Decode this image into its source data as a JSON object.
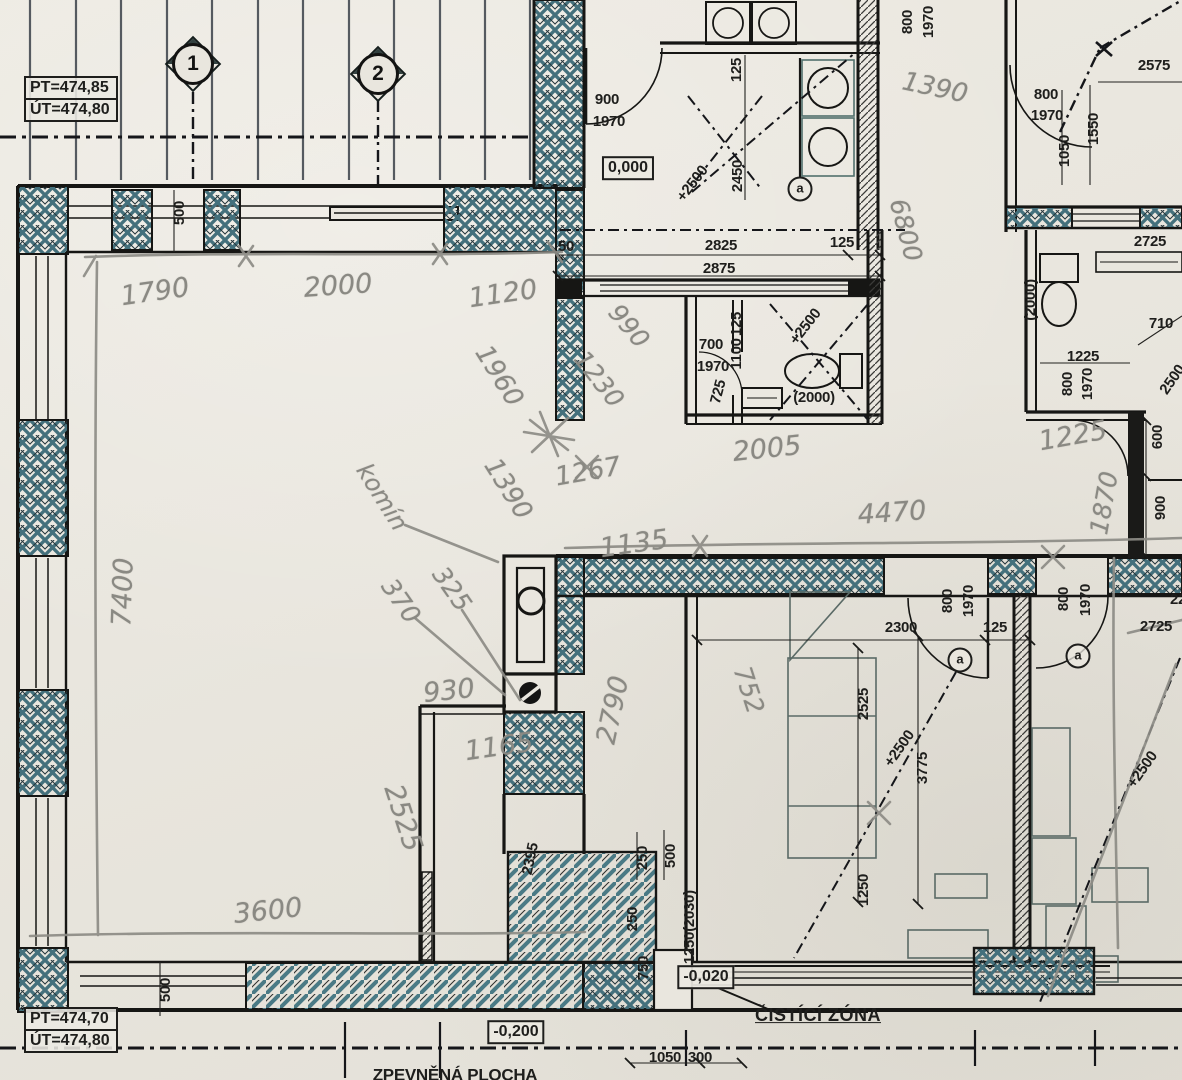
{
  "drawing_type": "floor-plan",
  "colors": {
    "paper": "#e9e6de",
    "ink": "#1a1a18",
    "hatch": "#41707d",
    "pencil": "#8d8c86"
  },
  "elevations": {
    "top": {
      "pt": "PT=474,85",
      "ut": "ÚT=474,80"
    },
    "bottom": {
      "pt": "PT=474,70",
      "ut": "ÚT=474,80"
    }
  },
  "axis_markers": [
    {
      "label": "1"
    },
    {
      "label": "2"
    }
  ],
  "labels": [
    {
      "text": "500",
      "x": 180,
      "y": 213,
      "r": -90,
      "c": "p"
    },
    {
      "text": "50",
      "x": 566,
      "y": 247,
      "c": "p"
    },
    {
      "text": "900",
      "x": 607,
      "y": 100,
      "c": "p"
    },
    {
      "text": "1970",
      "x": 609,
      "y": 122,
      "c": "p"
    },
    {
      "text": "0,000",
      "x": 628,
      "y": 168,
      "c": "b",
      "name": "level-label"
    },
    {
      "text": "125",
      "x": 737,
      "y": 70,
      "r": -90,
      "c": "p"
    },
    {
      "text": "2450",
      "x": 738,
      "y": 176,
      "r": -90,
      "c": "p"
    },
    {
      "text": "+2500",
      "x": 693,
      "y": 184,
      "r": -52,
      "c": "p"
    },
    {
      "text": "2825",
      "x": 721,
      "y": 246,
      "c": "p"
    },
    {
      "text": "125",
      "x": 842,
      "y": 243,
      "c": "p"
    },
    {
      "text": "2875",
      "x": 719,
      "y": 269,
      "c": "p"
    },
    {
      "text": "700",
      "x": 711,
      "y": 345,
      "c": "p"
    },
    {
      "text": "1970",
      "x": 713,
      "y": 367,
      "c": "p"
    },
    {
      "text": "125",
      "x": 737,
      "y": 324,
      "r": -90,
      "c": "p"
    },
    {
      "text": "1100",
      "x": 737,
      "y": 354,
      "r": -90,
      "c": "p"
    },
    {
      "text": "725",
      "x": 719,
      "y": 392,
      "r": -75,
      "c": "p"
    },
    {
      "text": "+2500",
      "x": 806,
      "y": 327,
      "r": -52,
      "c": "p"
    },
    {
      "text": "(2000)",
      "x": 814,
      "y": 398,
      "c": "p"
    },
    {
      "text": "800",
      "x": 908,
      "y": 22,
      "r": -90,
      "c": "p"
    },
    {
      "text": "1970",
      "x": 929,
      "y": 22,
      "r": -90,
      "c": "p"
    },
    {
      "text": "2575",
      "x": 1154,
      "y": 66,
      "c": "p"
    },
    {
      "text": "800",
      "x": 1046,
      "y": 95,
      "c": "p"
    },
    {
      "text": "1970",
      "x": 1047,
      "y": 116,
      "c": "p"
    },
    {
      "text": "1050",
      "x": 1065,
      "y": 151,
      "r": -90,
      "c": "p"
    },
    {
      "text": "1550",
      "x": 1094,
      "y": 129,
      "r": -90,
      "c": "p"
    },
    {
      "text": "2725",
      "x": 1150,
      "y": 242,
      "c": "p"
    },
    {
      "text": "(2000)",
      "x": 1031,
      "y": 300,
      "r": -90,
      "c": "p"
    },
    {
      "text": "1225",
      "x": 1083,
      "y": 357,
      "c": "p"
    },
    {
      "text": "710",
      "x": 1161,
      "y": 324,
      "c": "p"
    },
    {
      "text": "800",
      "x": 1068,
      "y": 384,
      "r": -90,
      "c": "p"
    },
    {
      "text": "1970",
      "x": 1088,
      "y": 384,
      "r": -90,
      "c": "p"
    },
    {
      "text": "2500",
      "x": 1173,
      "y": 380,
      "r": -55,
      "c": "p"
    },
    {
      "text": "600",
      "x": 1158,
      "y": 437,
      "r": -90,
      "c": "p"
    },
    {
      "text": "900",
      "x": 1161,
      "y": 508,
      "r": -90,
      "c": "p"
    },
    {
      "text": "2300",
      "x": 901,
      "y": 628,
      "c": "p"
    },
    {
      "text": "125",
      "x": 995,
      "y": 628,
      "c": "p"
    },
    {
      "text": "800",
      "x": 948,
      "y": 601,
      "r": -90,
      "c": "p"
    },
    {
      "text": "1970",
      "x": 969,
      "y": 601,
      "r": -90,
      "c": "p"
    },
    {
      "text": "800",
      "x": 1064,
      "y": 599,
      "r": -90,
      "c": "p"
    },
    {
      "text": "1970",
      "x": 1086,
      "y": 600,
      "r": -90,
      "c": "p"
    },
    {
      "text": "22",
      "x": 1178,
      "y": 600,
      "c": "p"
    },
    {
      "text": "2725",
      "x": 1156,
      "y": 627,
      "c": "p"
    },
    {
      "text": "2525",
      "x": 864,
      "y": 704,
      "r": -90,
      "c": "p"
    },
    {
      "text": "+2500",
      "x": 900,
      "y": 749,
      "r": -55,
      "c": "p"
    },
    {
      "text": "3775",
      "x": 923,
      "y": 768,
      "r": -90,
      "c": "p"
    },
    {
      "text": "1250",
      "x": 864,
      "y": 890,
      "r": -90,
      "c": "p"
    },
    {
      "text": "+2500",
      "x": 1143,
      "y": 770,
      "r": -55,
      "c": "p"
    },
    {
      "text": "2395",
      "x": 531,
      "y": 859,
      "r": -78,
      "c": "p"
    },
    {
      "text": "250",
      "x": 643,
      "y": 858,
      "r": -90,
      "c": "p"
    },
    {
      "text": "500",
      "x": 671,
      "y": 856,
      "r": -90,
      "c": "p"
    },
    {
      "text": "250",
      "x": 633,
      "y": 919,
      "r": -90,
      "c": "p"
    },
    {
      "text": "750",
      "x": 644,
      "y": 968,
      "r": -90,
      "c": "p"
    },
    {
      "text": "(2030)",
      "x": 690,
      "y": 911,
      "r": -90,
      "c": "p"
    },
    {
      "text": "1250",
      "x": 690,
      "y": 948,
      "r": -90,
      "c": "p"
    },
    {
      "text": "-0,020",
      "x": 706,
      "y": 977,
      "c": "b",
      "name": "level-label"
    },
    {
      "text": "ČISTÍCÍ ZÓNA",
      "x": 818,
      "y": 1016,
      "c": "u",
      "name": "zone-label"
    },
    {
      "text": "-0,200",
      "x": 516,
      "y": 1032,
      "c": "b",
      "name": "level-label"
    },
    {
      "text": "ZPEVNĚNÁ PLOCHA",
      "x": 455,
      "y": 1076,
      "c": "p",
      "s": 17,
      "name": "area-label"
    },
    {
      "text": "1050",
      "x": 665,
      "y": 1058,
      "c": "p"
    },
    {
      "text": "300",
      "x": 700,
      "y": 1058,
      "c": "p"
    },
    {
      "text": "500",
      "x": 166,
      "y": 990,
      "r": -90,
      "c": "p"
    },
    {
      "text": "1790",
      "x": 155,
      "y": 292,
      "r": -8,
      "c": "h"
    },
    {
      "text": "2000",
      "x": 338,
      "y": 286,
      "r": -4,
      "c": "h"
    },
    {
      "text": "1120",
      "x": 503,
      "y": 294,
      "r": -8,
      "c": "h"
    },
    {
      "text": "7400",
      "x": 123,
      "y": 592,
      "r": -88,
      "c": "h"
    },
    {
      "text": "3600",
      "x": 268,
      "y": 911,
      "r": -6,
      "c": "h"
    },
    {
      "text": "990",
      "x": 629,
      "y": 326,
      "r": 50,
      "c": "h",
      "s": 25
    },
    {
      "text": "1230",
      "x": 599,
      "y": 379,
      "r": 52,
      "c": "h",
      "s": 25
    },
    {
      "text": "1960",
      "x": 499,
      "y": 376,
      "r": 58,
      "c": "h",
      "s": 26
    },
    {
      "text": "1390",
      "x": 508,
      "y": 489,
      "r": 58,
      "c": "h",
      "s": 26
    },
    {
      "text": "1267",
      "x": 588,
      "y": 472,
      "r": -10,
      "c": "h",
      "s": 26
    },
    {
      "text": "2005",
      "x": 767,
      "y": 449,
      "r": -6,
      "c": "h"
    },
    {
      "text": "1135",
      "x": 634,
      "y": 544,
      "r": -8,
      "c": "h"
    },
    {
      "text": "4470",
      "x": 892,
      "y": 513,
      "r": -4,
      "c": "h"
    },
    {
      "text": "komín",
      "x": 382,
      "y": 497,
      "r": 58,
      "c": "h",
      "s": 24
    },
    {
      "text": "370",
      "x": 401,
      "y": 601,
      "r": 55,
      "c": "h",
      "s": 25
    },
    {
      "text": "325",
      "x": 452,
      "y": 589,
      "r": 55,
      "c": "h",
      "s": 25
    },
    {
      "text": "930",
      "x": 449,
      "y": 691,
      "r": -6,
      "c": "h"
    },
    {
      "text": "1165",
      "x": 499,
      "y": 747,
      "r": -8,
      "c": "h"
    },
    {
      "text": "2525",
      "x": 403,
      "y": 818,
      "r": 72,
      "c": "h"
    },
    {
      "text": "2790",
      "x": 613,
      "y": 710,
      "r": -78,
      "c": "h"
    },
    {
      "text": "752",
      "x": 749,
      "y": 690,
      "r": 72,
      "c": "h",
      "s": 25
    },
    {
      "text": "1390",
      "x": 935,
      "y": 88,
      "r": 12,
      "c": "h",
      "s": 26
    },
    {
      "text": "6800",
      "x": 906,
      "y": 230,
      "r": 75,
      "c": "h",
      "s": 25
    },
    {
      "text": "1225",
      "x": 1073,
      "y": 436,
      "r": -10,
      "c": "h"
    },
    {
      "text": "1870",
      "x": 1104,
      "y": 503,
      "r": -80,
      "c": "h",
      "s": 25
    },
    {
      "text": "a",
      "x": 800,
      "y": 189,
      "c": "c",
      "name": "reference-marker"
    },
    {
      "text": "a",
      "x": 960,
      "y": 660,
      "c": "c",
      "name": "reference-marker"
    },
    {
      "text": "a",
      "x": 1078,
      "y": 656,
      "c": "c",
      "name": "reference-marker"
    }
  ]
}
